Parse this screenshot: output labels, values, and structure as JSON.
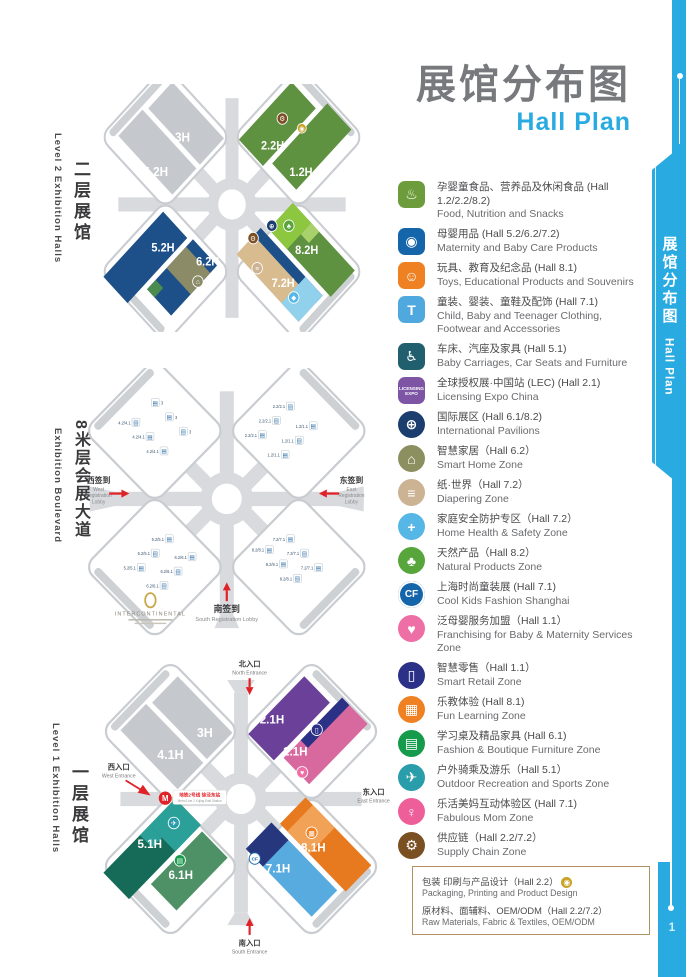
{
  "page_number": "1",
  "title": {
    "zh": "展馆分布图",
    "en": "Hall Plan"
  },
  "side_tab": {
    "zh": "展馆分布图",
    "en": "Hall Plan"
  },
  "icons": {
    "supply_chain": "⚙",
    "packaging": "◉",
    "international": "⊕",
    "natural": "♣",
    "smart_home": "⌂",
    "diapering": "≡",
    "safety": "◆",
    "smart_retail": "▯",
    "franchising": "♥",
    "outdoor": "✈",
    "furniture": "▤",
    "fun_learning": "▦",
    "cool_kids": "CF",
    "metro": "M",
    "escalator": "▤"
  },
  "maps": {
    "level2": {
      "label_zh": "二层展馆",
      "label_en": "Level 2  Exhibition Halls",
      "halls": {
        "h3": "3H",
        "h42": "4.2H",
        "h22": "2.2H",
        "h12": "1.2H",
        "h52": "5.2H",
        "h62": "6.2H",
        "h82": "8.2H",
        "h72": "7.2H"
      }
    },
    "boulevard": {
      "label_zh": "8米层会展大道",
      "label_en": "Exhibition Boulevard",
      "west_zh": "西签到",
      "west_en1": "West",
      "west_en2": "Registration",
      "west_en3": "Lobby",
      "east_zh": "东签到",
      "east_en1": "East",
      "east_en2": "Registration",
      "east_en3": "Lobby",
      "south_zh": "南签到",
      "south_en": "South Registration Lobby",
      "hotel": "INTERCONTINENTAL",
      "escalator_labels": [
        "3",
        "4.2/4.1",
        "2.2/2.1",
        "1.2/1.1",
        "5.2/5.1",
        "6.2/6.1",
        "7.2/7.1",
        "8.2/8.1"
      ]
    },
    "level1": {
      "label_zh": "一层展馆",
      "label_en": "Level 1 Exhibition Halls",
      "halls": {
        "h3": "3H",
        "h41": "4.1H",
        "h21": "2.1H",
        "h11": "1.1H",
        "h51": "5.1H",
        "h61": "6.1H",
        "h81": "8.1H",
        "h71": "7.1H"
      },
      "north_zh": "北入口",
      "north_en": "North Entrance",
      "south_zh": "南入口",
      "south_en": "South Entrance",
      "west_zh": "西入口",
      "west_en": "West Entrance",
      "east_zh": "东入口",
      "east_en": "East Entrance",
      "metro_zh": "地铁2号线 徐泾东站",
      "metro_en": "Metro Line 2 Xujing East Station"
    }
  },
  "legend": {
    "items": [
      {
        "name": "food-icon",
        "shape": "square",
        "color": "#6d9c3c",
        "glyph": "♨",
        "zh": "孕婴童食品、营养品及休闲食品 (Hall 1.2/2.2/8.2)",
        "en": "Food, Nutrition and Snacks"
      },
      {
        "name": "maternity-care-icon",
        "shape": "square",
        "color": "#1565ab",
        "glyph": "◉",
        "zh": "母婴用品 (Hall 5.2/6.2/7.2)",
        "en": "Maternity and Baby Care Products"
      },
      {
        "name": "toys-icon",
        "shape": "square",
        "color": "#ef8122",
        "glyph": "☺",
        "zh": "玩具、教育及纪念品 (Hall 8.1)",
        "en": "Toys, Educational Products and Souvenirs"
      },
      {
        "name": "clothing-icon",
        "shape": "square",
        "color": "#4fa8de",
        "glyph": "T",
        "zh": "童装、婴装、童鞋及配饰 (Hall 7.1)",
        "en": "Child, Baby and Teenager Clothing, Footwear and Accessories"
      },
      {
        "name": "carriages-icon",
        "shape": "square",
        "color": "#215e6e",
        "glyph": "♿",
        "zh": "车床、汽座及家具 (Hall 5.1)",
        "en": "Baby Carriages, Car Seats and Furniture"
      },
      {
        "name": "licensing-expo-icon",
        "shape": "square",
        "color": "#7d55a4",
        "glyph": "LICENSING EXPO",
        "zh": "全球授权展·中国站 (LEC) (Hall 2.1)",
        "en": "Licensing Expo China"
      },
      {
        "name": "international-pavilions-icon",
        "shape": "circle",
        "color": "#1c3e6e",
        "glyph": "⊕",
        "zh": "国际展区 (Hall 6.1/8.2)",
        "en": "International Pavilions"
      },
      {
        "name": "smart-home-icon",
        "shape": "circle",
        "color": "#8c9060",
        "glyph": "⌂",
        "zh": "智慧家居（Hall 6.2）",
        "en": "Smart Home Zone"
      },
      {
        "name": "diapering-icon",
        "shape": "circle",
        "color": "#cbb394",
        "glyph": "≡",
        "zh": "纸·世界（Hall 7.2）",
        "en": "Diapering Zone"
      },
      {
        "name": "home-safety-icon",
        "shape": "circle",
        "color": "#56b7e6",
        "glyph": "+",
        "zh": "家庭安全防护专区（Hall 7.2）",
        "en": "Home Health & Safety Zone"
      },
      {
        "name": "natural-products-icon",
        "shape": "circle",
        "color": "#58a53c",
        "glyph": "♣",
        "zh": "天然产品（Hall 8.2）",
        "en": "Natural Products Zone"
      },
      {
        "name": "cool-kids-fashion-icon",
        "shape": "circle",
        "color": "#1565ab",
        "glyph": "CF",
        "zh": "上海时尚童装展 (Hall 7.1)",
        "en": "Cool Kids Fashion Shanghai"
      },
      {
        "name": "franchising-icon",
        "shape": "circle",
        "color": "#ee6ea6",
        "glyph": "♥",
        "zh": "泛母婴服务加盟（Hall 1.1）",
        "en": "Franchising for Baby & Maternity Services Zone"
      },
      {
        "name": "smart-retail-icon",
        "shape": "circle",
        "color": "#2b3187",
        "glyph": "▯",
        "zh": "智慧零售（Hall 1.1）",
        "en": "Smart Retail Zone"
      },
      {
        "name": "fun-learning-icon",
        "shape": "circle",
        "color": "#ef8122",
        "glyph": "▦",
        "zh": "乐教体验 (Hall 8.1)",
        "en": "Fun Learning Zone"
      },
      {
        "name": "boutique-furniture-icon",
        "shape": "circle",
        "color": "#169a4b",
        "glyph": "▤",
        "zh": "学习桌及精品家具 (Hall 6.1)",
        "en": "Fashion & Boutique Furniture Zone"
      },
      {
        "name": "outdoor-recreation-icon",
        "shape": "circle",
        "color": "#2a9daa",
        "glyph": "✈",
        "zh": "户外骑乘及游乐（Hall 5.1）",
        "en": "Outdoor Recreation and Sports Zone"
      },
      {
        "name": "fabulous-mom-icon",
        "shape": "circle",
        "color": "#ee5f9a",
        "glyph": "♀",
        "zh": "乐活美妈互动体验区 (Hall 7.1)",
        "en": "Fabulous Mom Zone"
      },
      {
        "name": "supply-chain-icon",
        "shape": "circle",
        "color": "#7a4f22",
        "glyph": "⚙",
        "zh": "供应链（Hall 2.2/7.2）",
        "en": "Supply Chain Zone"
      }
    ],
    "box": {
      "l1_zh": "包装 印刷与产品设计（Hall 2.2）",
      "l1_en": "Packaging, Printing and Product Design",
      "l2_zh": "原材料、面辅料、OEM/ODM（Hall 2.2/7.2）",
      "l2_en": "Raw Materials, Fabric & Textiles, OEM/ODM"
    }
  }
}
